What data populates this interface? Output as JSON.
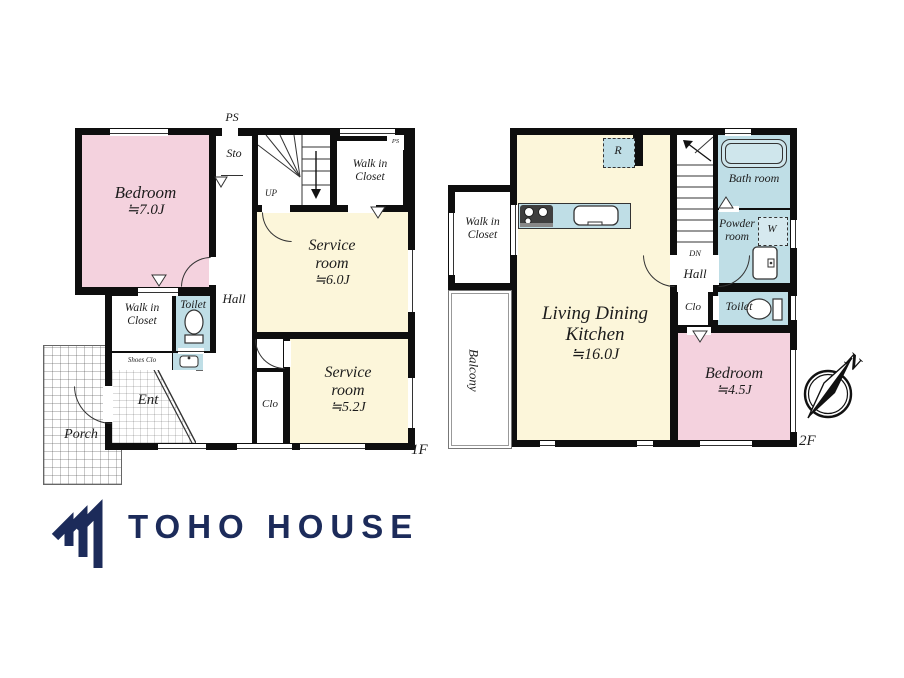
{
  "colors": {
    "bedroom_pink": "#f4d2de",
    "service_cream": "#fcf6da",
    "wet_area_blue": "#bfdee6",
    "wall_black": "#0e0e0e",
    "logo_navy": "#1c2b5a"
  },
  "floor1": {
    "floor_label": "1F",
    "ps_duct_label": "PS",
    "ps_corner_label": "PS",
    "rooms": {
      "bedroom": {
        "name": "Bedroom",
        "area": "≒7.0J"
      },
      "service_room_upper": {
        "name": "Service room",
        "area": "≒6.0J"
      },
      "service_room_lower": {
        "name": "Service room",
        "area": "≒5.2J"
      },
      "walk_in_closet_upper": "Walk in Closet",
      "walk_in_closet_lower": "Walk in Closet",
      "storage": "Sto",
      "stairs_direction": "UP",
      "hall": "Hall",
      "toilet": "Toilet",
      "shoes_closet": "Shoes Clo",
      "entrance": "Ent",
      "porch": "Porch",
      "closet": "Clo"
    }
  },
  "floor2": {
    "floor_label": "2F",
    "rooms": {
      "living_dining_kitchen": {
        "name": "Living Dining Kitchen",
        "area": "≒16.0J"
      },
      "bedroom": {
        "name": "Bedroom",
        "area": "≒4.5J"
      },
      "bath_room": "Bath room",
      "powder_room": "Powder room",
      "washer": "W",
      "refrigerator": "R",
      "toilet": "Toilet",
      "closet": "Clo",
      "hall": "Hall",
      "stairs_direction": "DN",
      "walk_in_closet": "Walk in Closet",
      "balcony": "Balcony"
    }
  },
  "compass": {
    "north_label": "N"
  },
  "footer": {
    "company": "TOHO HOUSE"
  }
}
